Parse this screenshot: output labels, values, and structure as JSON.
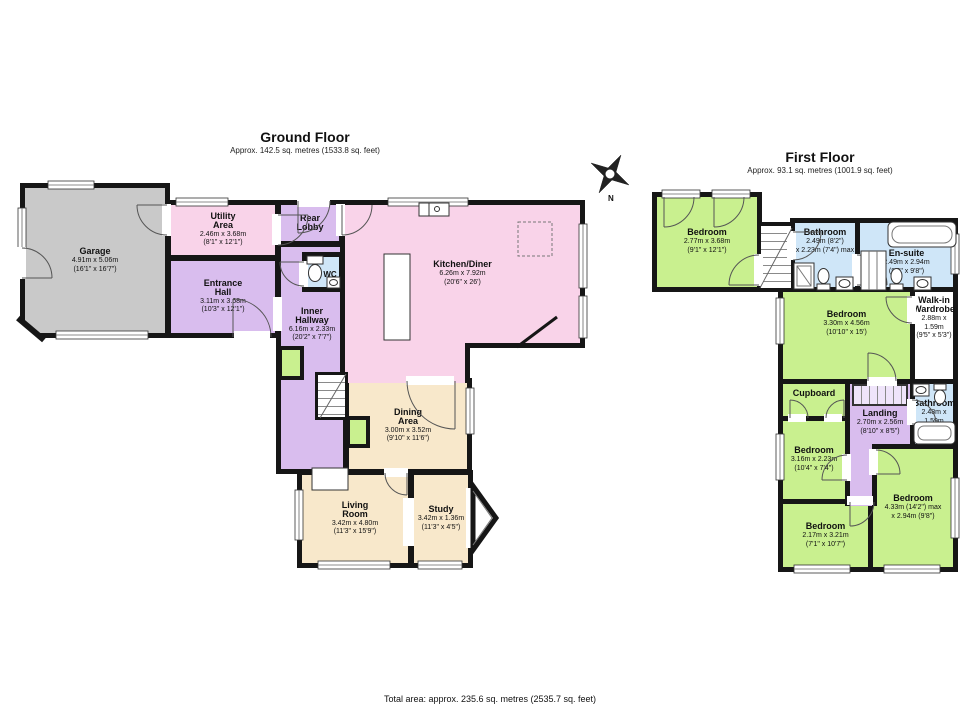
{
  "ground_floor": {
    "title": "Ground Floor",
    "subtitle": "Approx. 142.5 sq. metres (1533.8 sq. feet)",
    "rooms": {
      "garage": {
        "name": "Garage",
        "metric": "4.91m x 5.06m",
        "imperial": "(16'1\" x 16'7\")"
      },
      "utility": {
        "name": "Utility Area",
        "metric": "2.46m x 3.68m",
        "imperial": "(8'1\" x 12'1\")"
      },
      "rear_lobby": {
        "name": "Rear Lobby"
      },
      "wc": {
        "name": "WC"
      },
      "entrance_hall": {
        "name": "Entrance Hall",
        "metric": "3.11m x 3.68m",
        "imperial": "(10'3\" x 12'1\")"
      },
      "inner_hallway": {
        "name": "Inner Hallway",
        "metric": "6.16m x 2.33m",
        "imperial": "(20'2\" x 7'7\")"
      },
      "kitchen_diner": {
        "name": "Kitchen/Diner",
        "metric": "6.26m x 7.92m",
        "imperial": "(20'6\" x 26')"
      },
      "dining_area": {
        "name": "Dining Area",
        "metric": "3.00m x 3.52m",
        "imperial": "(9'10\" x 11'6\")"
      },
      "living_room": {
        "name": "Living Room",
        "metric": "3.42m x 4.80m",
        "imperial": "(11'3\" x 15'9\")"
      },
      "study": {
        "name": "Study",
        "metric": "3.42m x 1.36m",
        "imperial": "(11'3\" x 4'5\")"
      }
    }
  },
  "first_floor": {
    "title": "First Floor",
    "subtitle": "Approx. 93.1 sq. metres (1001.9 sq. feet)",
    "rooms": {
      "bedroom_1": {
        "name": "Bedroom",
        "metric": "2.77m x 3.68m",
        "imperial": "(9'1\" x 12'1\")"
      },
      "bathroom_top": {
        "name": "Bathroom",
        "metric": "2.49m (8'2\")",
        "imperial": "x 2.23m (7'4\") max"
      },
      "ensuite": {
        "name": "En-suite",
        "metric": "2.49m x 2.94m",
        "imperial": "(8'2\" x 9'8\")"
      },
      "bedroom_2": {
        "name": "Bedroom",
        "metric": "3.30m x 4.56m",
        "imperial": "(10'10\" x 15')"
      },
      "walk_in_wardrobe": {
        "name": "Walk-in Wardrobe",
        "metric": "2.88m x 1.59m",
        "imperial": "(9'5\" x 5'3\")"
      },
      "cupboard": {
        "name": "Cupboard"
      },
      "landing": {
        "name": "Landing",
        "metric": "2.70m x 2.56m",
        "imperial": "(8'10\" x 8'5\")"
      },
      "bathroom_small": {
        "name": "Bathroom",
        "metric": "2.48m x 1.59m",
        "imperial": "(8'2\" x 5'3\")"
      },
      "bedroom_3": {
        "name": "Bedroom",
        "metric": "3.16m x 2.23m",
        "imperial": "(10'4\" x 7'4\")"
      },
      "bedroom_4": {
        "name": "Bedroom",
        "metric": "2.17m x 3.21m",
        "imperial": "(7'1\" x 10'7\")"
      },
      "bedroom_5": {
        "name": "Bedroom",
        "metric": "4.33m (14'2\") max",
        "imperial": "x 2.94m (9'8\")"
      }
    }
  },
  "footer": {
    "total_area": "Total area: approx. 235.6 sq. metres (2535.7 sq. feet)"
  },
  "compass": {
    "label": "N"
  },
  "colors": {
    "bedroom_green": "#c9f08f",
    "bathroom_blue": "#cfe6f8",
    "hallway_purple": "#d9bdee",
    "kitchen_pink": "#f9d3e9",
    "living_cream": "#f8e8cb",
    "garage_gray": "#c9c9c9",
    "wall": "#161616"
  }
}
